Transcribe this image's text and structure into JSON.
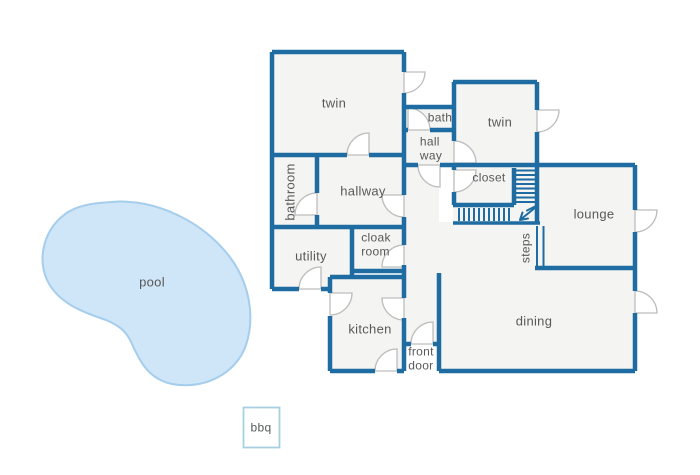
{
  "title": "house floor plan with pool",
  "colors": {
    "wall": "#1e6ca1",
    "room_fill": "#f4f4f2",
    "door_stroke": "#bdbdbd",
    "label": "#58595a",
    "pool_fill": "#cfe5f8",
    "pool_stroke": "#a5cdec",
    "bbq_stroke": "#a9cfe2"
  },
  "rooms": [
    {
      "id": "twin1",
      "label": "twin"
    },
    {
      "id": "bath",
      "label": "bath"
    },
    {
      "id": "twin2",
      "label": "twin"
    },
    {
      "id": "hallway_small",
      "label": "hall\nway"
    },
    {
      "id": "bathroom",
      "label": "bathroom"
    },
    {
      "id": "hallway",
      "label": "hallway"
    },
    {
      "id": "closet",
      "label": "closet"
    },
    {
      "id": "lounge",
      "label": "lounge"
    },
    {
      "id": "utility",
      "label": "utility"
    },
    {
      "id": "cloakroom",
      "label": "cloak\nroom"
    },
    {
      "id": "steps",
      "label": "steps"
    },
    {
      "id": "kitchen",
      "label": "kitchen"
    },
    {
      "id": "dining",
      "label": "dining"
    },
    {
      "id": "front_door",
      "label": "front\ndoor"
    }
  ],
  "outdoor": [
    {
      "id": "pool",
      "label": "pool"
    },
    {
      "id": "bbq",
      "label": "bbq"
    }
  ]
}
